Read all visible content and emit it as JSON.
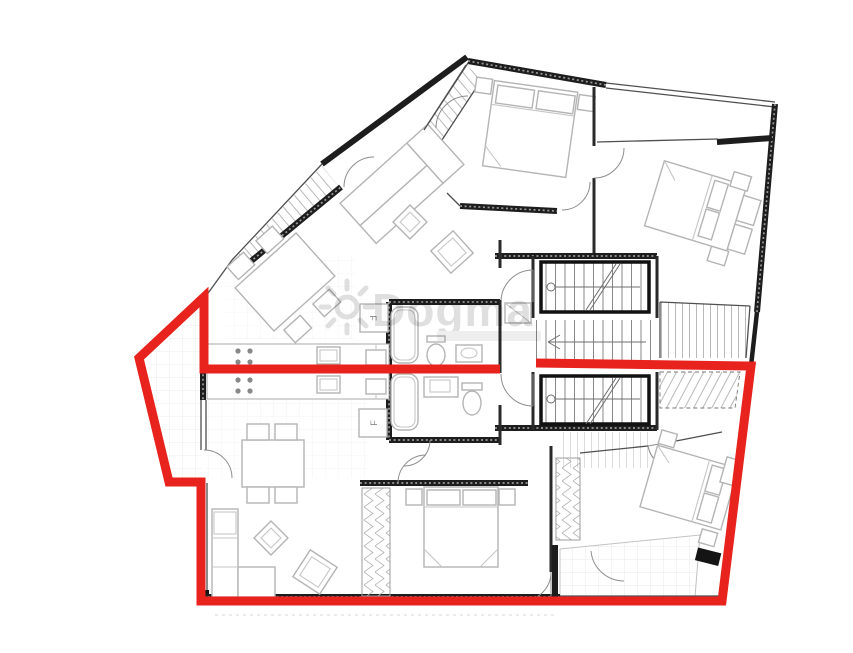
{
  "watermark": {
    "text": "Dogma"
  },
  "plan_labels": {
    "fridge": "F"
  },
  "highlight": {
    "color": "#e8231d",
    "stroke_width": 9,
    "outline_points": "536,363 751,366 722,601 201,601 201,482 169,482 139,358 204,297 204,369 500,369"
  },
  "colors": {
    "background": "#ffffff",
    "walls": "#1d1d1d",
    "furniture": "#b4b4b4",
    "watermark": "#dcdcdc",
    "highlight_red": "#e8231d"
  }
}
